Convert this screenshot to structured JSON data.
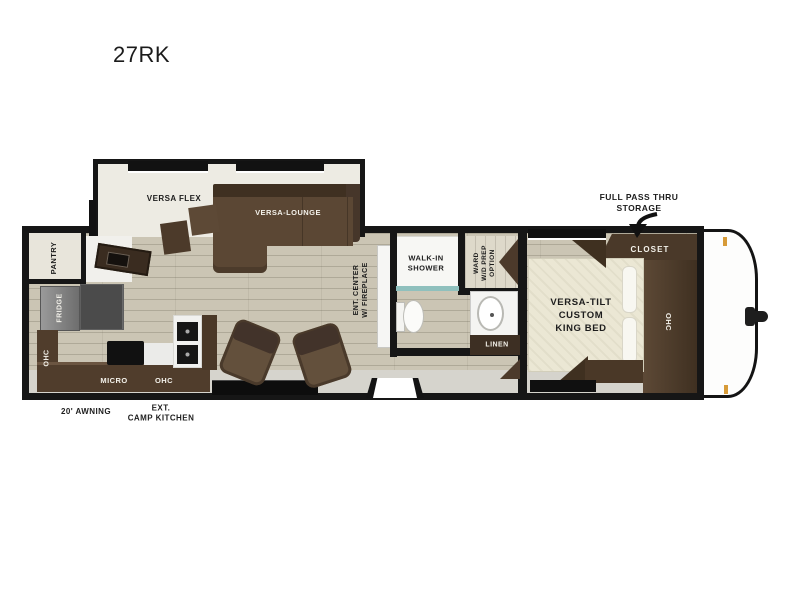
{
  "title": "27RK",
  "exterior": {
    "pass_thru": "FULL PASS THRU\nSTORAGE",
    "awning": "20' AWNING",
    "camp_kitchen": "EXT.\nCAMP KITCHEN"
  },
  "living": {
    "versa_flex": "VERSA FLEX",
    "versa_lounge": "VERSA-LOUNGE",
    "ent_center": "ENT. CENTER\nW/ FIREPLACE"
  },
  "kitchen": {
    "pantry": "PANTRY",
    "fridge": "FRIDGE",
    "ohc_rear": "OHC",
    "micro": "MICRO",
    "ohc": "OHC"
  },
  "bath": {
    "shower": "WALK-IN\nSHOWER",
    "ward": "WARD\nW/D PREP\nOPTION",
    "linen": "LINEN"
  },
  "bedroom": {
    "closet": "CLOSET",
    "bed": "VERSA-TILT\nCUSTOM\nKING BED",
    "ohc": "OHC"
  },
  "colors": {
    "wall": "#161616",
    "floor": "#cbc5b4",
    "slide_floor": "#edebe3",
    "sofa": "#5b4734",
    "cabinet": "#4c3a2b",
    "bed": "#ebe7d4",
    "fridge": "#7a7a7a",
    "glass": "#8fc0bd",
    "marker_light": "#d79b38"
  }
}
